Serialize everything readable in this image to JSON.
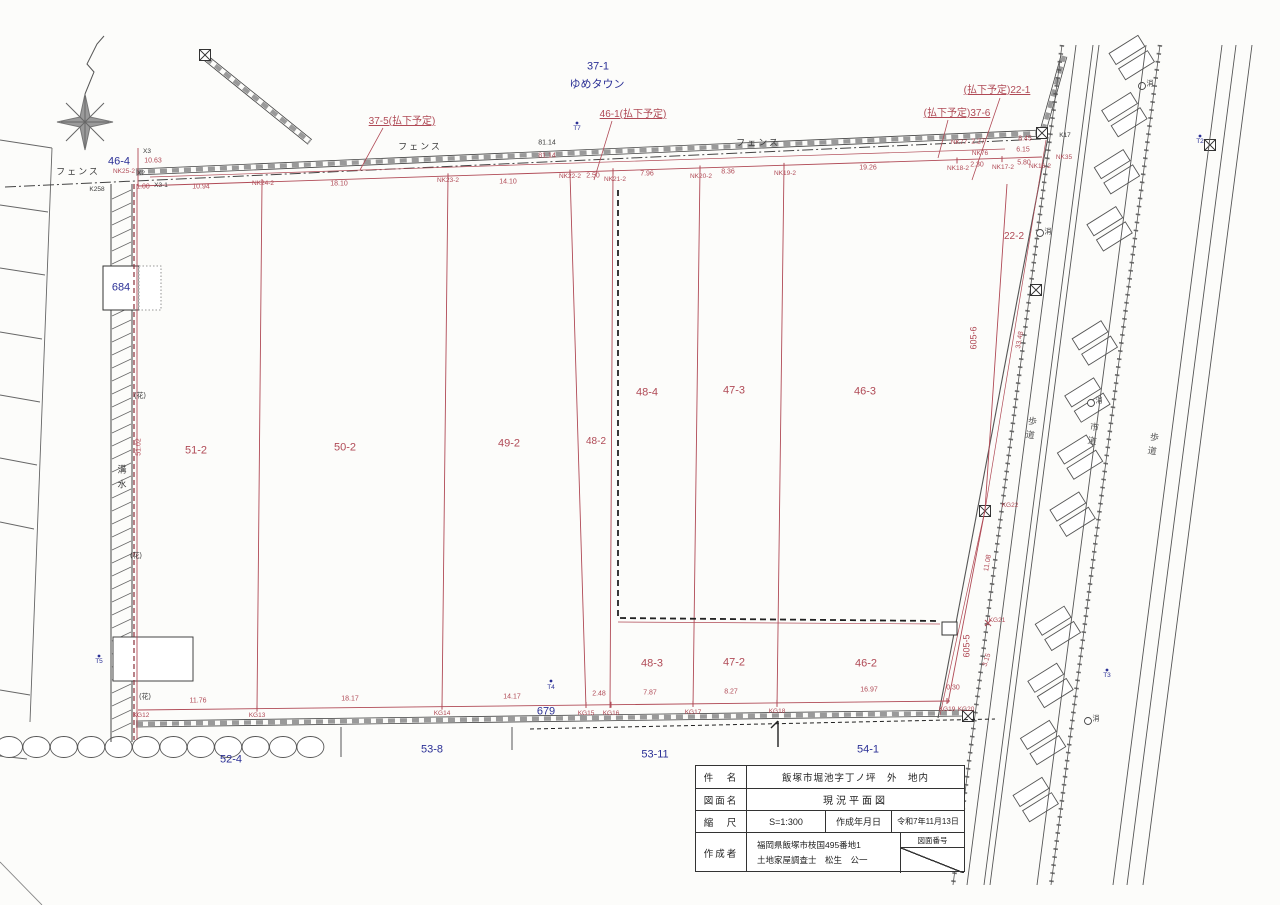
{
  "colors": {
    "red": "#b04a56",
    "blue": "#2b3096",
    "ink": "#3a3a3a"
  },
  "title_block": {
    "r1_label": "件　名",
    "r1_value": "飯塚市堀池字丁ノ坪　外　地内",
    "r2_label": "図面名",
    "r2_value": "現況平面図",
    "r3_label": "縮　尺",
    "r3_scale": "S=1:300",
    "r3_date_label": "作成年月日",
    "r3_date": "令和7年11月13日",
    "r4_label": "作成者",
    "r4_line1": "福岡県飯塚市枝国495番地1",
    "r4_line2": "土地家屋調査士　松生　公一",
    "corner_label": "図面番号"
  },
  "neighbor_parcels": {
    "p37_1": "37-1",
    "yumetown": "ゆめタウン",
    "p46_4": "46-4",
    "p684": "684",
    "p679": "679",
    "p52_4": "52-4",
    "p53_8": "53-8",
    "p53_11": "53-11",
    "p54_1": "54-1"
  },
  "parcels": {
    "p51_2": "51-2",
    "p50_2": "50-2",
    "p49_2": "49-2",
    "p48_2": "48-2",
    "p48_4": "48-4",
    "p47_3": "47-3",
    "p46_3": "46-3",
    "p48_3": "48-3",
    "p47_2": "47-2",
    "p46_2": "46-2",
    "p22_2": "22-2",
    "p605_6": "605-6",
    "p605_5": "605-5"
  },
  "annotations": {
    "h37_5": "37-5(払下予定)",
    "h46_1": "46-1(払下予定)",
    "h22_1": "(払下予定)22-1",
    "h37_6": "(払下予定)37-6",
    "fence": "フェンス",
    "gutter_c1": "溝",
    "gutter_c2": "水",
    "hana": "(花)",
    "sidewalk": "歩道",
    "roadway": "市道",
    "hydrant": "消"
  },
  "survey_points": {
    "x3": "X3",
    "x2": "X2",
    "x3_1": "X3-1",
    "k258": "K258",
    "k17": "K17",
    "nk25_2": "NK25-2",
    "nk24_2": "NK24-2",
    "nk23_2": "NK23-2",
    "nk22_2": "NK22-2",
    "nk21_2": "NK21-2",
    "nk20_2": "NK20-2",
    "nk19_2": "NK19-2",
    "nk18_2": "NK18-2",
    "nk17_2": "NK17-2",
    "nk16_2": "NK16-2",
    "nk77": "NK77",
    "nk76": "NK76",
    "nk35": "NK35",
    "kg12": "KG12",
    "kg13": "KG13",
    "kg14": "KG14",
    "kg15": "KG15",
    "kg16": "KG16",
    "kg17": "KG17",
    "kg18": "KG18",
    "kg19": "KG19",
    "kg20": "KG20",
    "kg21": "KG21",
    "kg22": "KG22",
    "t2": "T2",
    "t3": "T3",
    "t4": "T4",
    "t5": "T5",
    "t7": "T7"
  },
  "dimensions": {
    "top": {
      "d10_63": "10.63",
      "d1_00": "1.00",
      "d10_94": "10.94",
      "d18_10": "18.10",
      "d14_10": "14.10",
      "d2_50": "2.50",
      "d7_96": "7.96",
      "d8_36": "8.36",
      "d19_26": "19.26",
      "d2_30": "2.30",
      "d81_14a": "81.14",
      "d81_14b": "81.14",
      "d2_27": "2.27",
      "d8_45": "8.45",
      "d6_15": "6.15",
      "d5_80": "5.80"
    },
    "bottom": {
      "d11_76": "11.76",
      "d18_17": "18.17",
      "d14_17": "14.17",
      "d2_48": "2.48",
      "d7_87": "7.87",
      "d8_27": "8.27",
      "d16_97": "16.97",
      "d0_30": "0.30"
    },
    "side": {
      "d51_02": "51.02",
      "d33_48": "33.48",
      "d11_08": "11.08",
      "d3_15": "3.15"
    }
  }
}
